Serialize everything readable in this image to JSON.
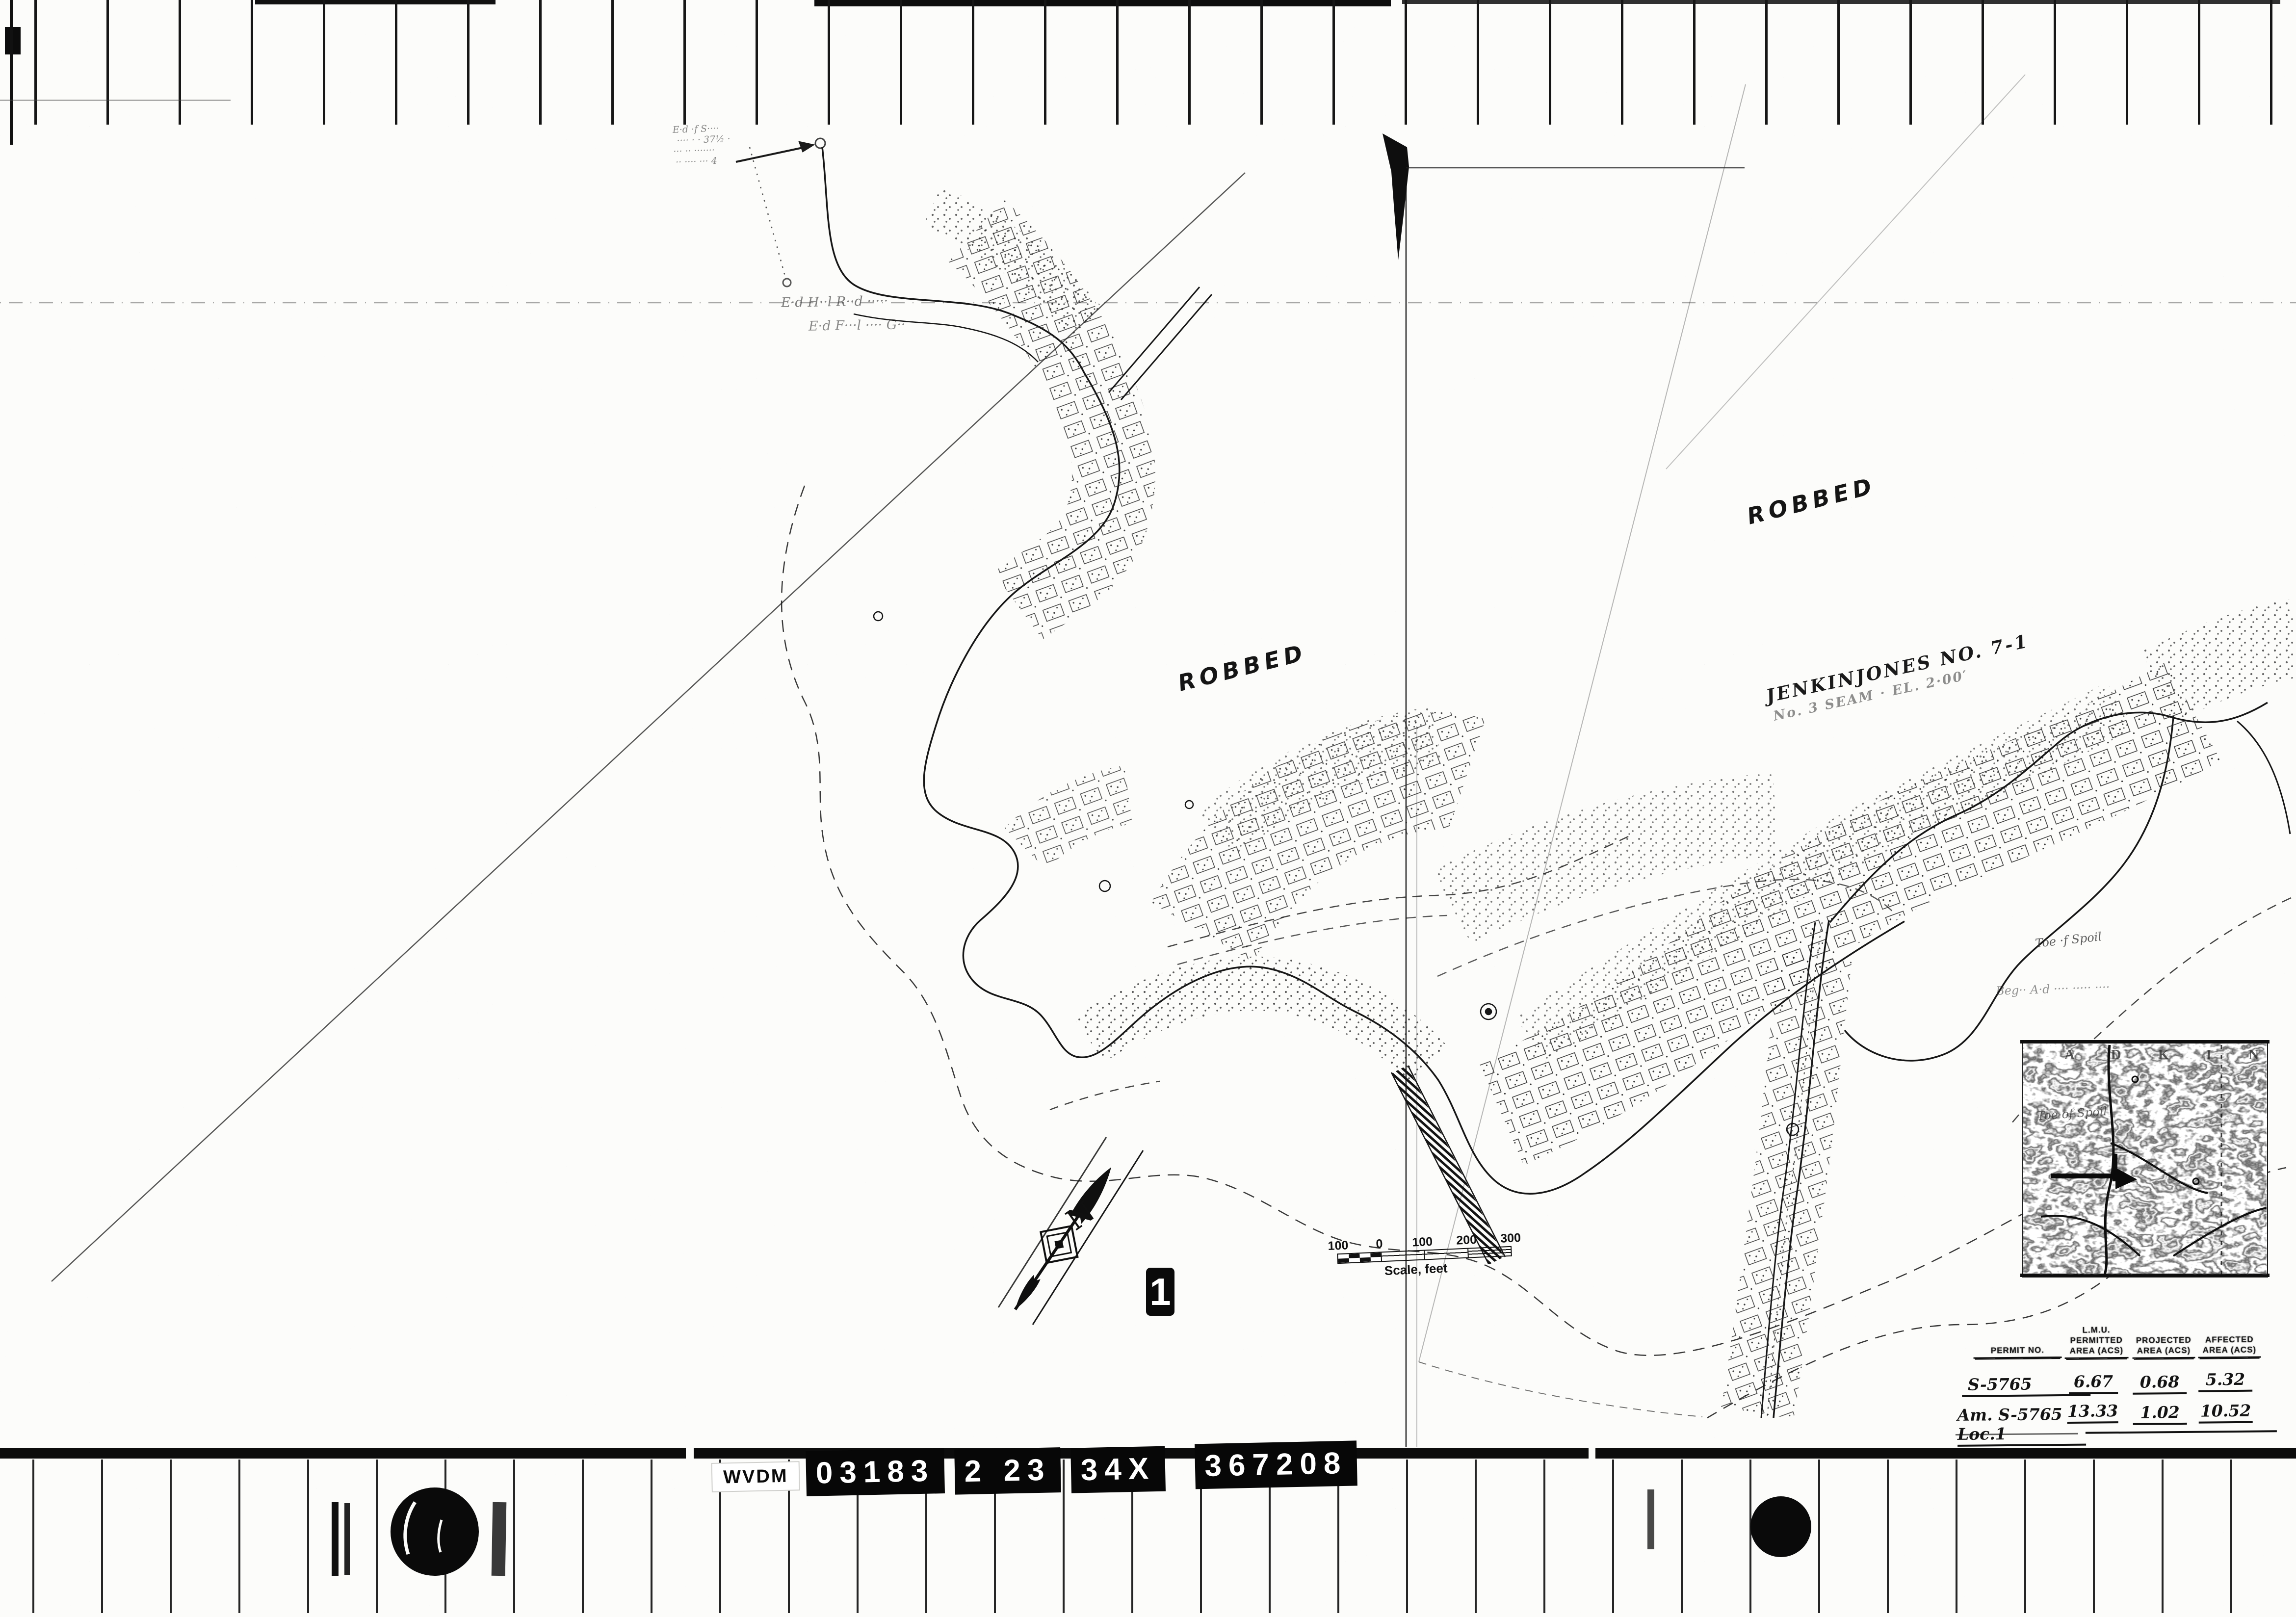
{
  "film": {
    "frame_tag": "1",
    "id_plate": {
      "agency": "WVDM",
      "tags": [
        "03183",
        "2 23",
        "34X",
        "367208"
      ]
    }
  },
  "map": {
    "north_label": "N",
    "labels": {
      "robbed_left": "ROBBED",
      "robbed_right": "ROBBED",
      "mine_title": "JENKINJONES  NO. 7-1",
      "mine_subtitle": "No. 3 SEAM · EL. 2·00′",
      "toe_of_spoil_upper": "Toe ·f Spoil",
      "toe_of_spoil_lower": "Toe of Spoil",
      "faint_note_right": "Beg·· A·d ···· ····· ····",
      "faint_note_mid_1": "E·d H··l R··d ·····",
      "faint_note_mid_2": "E·d F···l ···· G··",
      "faint_note_topleft_1": "E·d ·f S····",
      "faint_note_topleft_2": "···· · · 37½ ·",
      "faint_note_topleft_3": "··· ·· ·······",
      "faint_note_topleft_4": "·· ···· ··· 4"
    },
    "scale_bar": {
      "left_label": "100",
      "zero_label": "0",
      "tick_labels": [
        "100",
        "200",
        "300"
      ],
      "caption": "Scale, feet"
    },
    "inset": {
      "quad_letters": "A D K I N"
    },
    "table": {
      "columns": [
        {
          "l1": "PERMIT NO.",
          "l2": "",
          "l3": ""
        },
        {
          "l1": "L.M.U.",
          "l2": "PERMITTED",
          "l3": "AREA (ACS)"
        },
        {
          "l1": "PROJECTED",
          "l2": "AREA (ACS)",
          "l3": ""
        },
        {
          "l1": "AFFECTED",
          "l2": "AREA (ACS)",
          "l3": ""
        }
      ],
      "rows": [
        {
          "permit": "S-5765",
          "permitted": "6.67",
          "projected": "0.68",
          "affected": "5.32"
        },
        {
          "permit": "Am. S-5765 Loc.1",
          "permitted": "13.33",
          "projected": "1.02",
          "affected": "10.52"
        }
      ]
    }
  },
  "colors": {
    "ink": "#141414",
    "paper": "#fcfcfa"
  }
}
